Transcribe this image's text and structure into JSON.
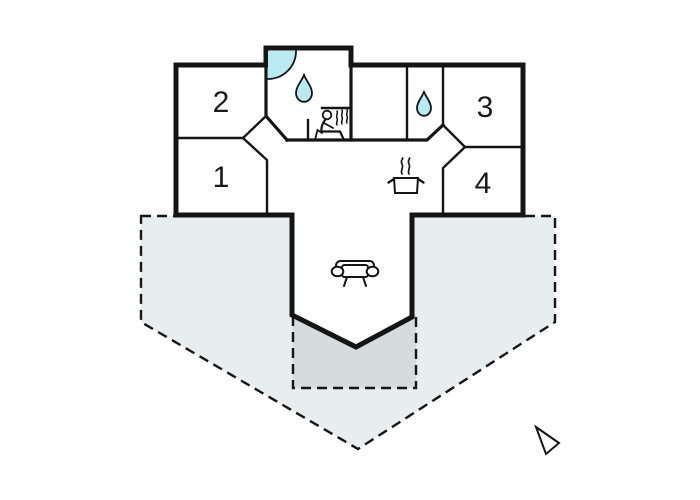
{
  "plan": {
    "type": "floor-plan",
    "rooms": [
      {
        "id": "room-1",
        "label": "1"
      },
      {
        "id": "room-2",
        "label": "2"
      },
      {
        "id": "room-3",
        "label": "3"
      },
      {
        "id": "room-4",
        "label": "4"
      }
    ],
    "areas": {
      "plot_boundary": "dashed pentagon lot outline",
      "terrace": "dashed darker rectangle terrace below living room",
      "living_room": "open hall with sofa, V-shaped bay at bottom",
      "bathroom": "top bump-out with corner shower, water drop and sauna",
      "wc": "small room with water drop",
      "kitchen": "open area with steaming pot"
    },
    "icons": [
      {
        "name": "shower-quarter-icon",
        "meaning": "corner shower"
      },
      {
        "name": "water-drop-bath-icon",
        "meaning": "bathroom water"
      },
      {
        "name": "sauna-person-icon",
        "meaning": "sauna"
      },
      {
        "name": "water-drop-wc-icon",
        "meaning": "WC water"
      },
      {
        "name": "cooking-pot-icon",
        "meaning": "kitchen"
      },
      {
        "name": "sofa-icon",
        "meaning": "living room"
      },
      {
        "name": "north-arrow-icon",
        "meaning": "orientation arrow"
      }
    ]
  },
  "colors": {
    "wall": "#151515",
    "water": "#b9eaf2",
    "plot": "#e8eeed",
    "terrace": "#d5dcdb",
    "background": "#ffffff",
    "label": "#1a1a1a"
  }
}
